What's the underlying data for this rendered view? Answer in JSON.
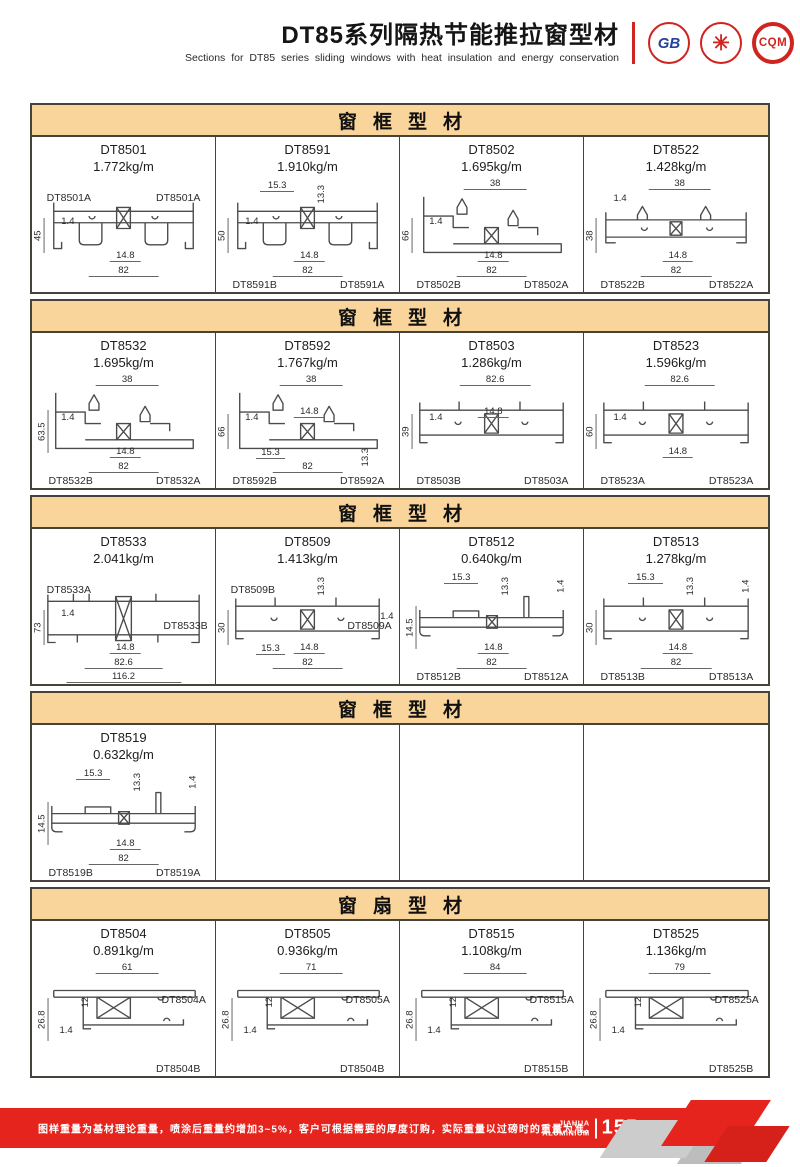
{
  "header": {
    "title": "DT85系列隔热节能推拉窗型材",
    "subtitle": "Sections for DT85 series sliding windows with heat insulation and energy conservation",
    "logos": {
      "gb": "GB",
      "star": "✳",
      "cqm": "CQM"
    }
  },
  "sections": [
    {
      "title": "窗框型材",
      "cells": [
        {
          "model": "DT8501",
          "weight": "1.772kg/m",
          "shape": "double",
          "labels": [
            {
              "v": "DT8501A",
              "role": "lbl-tl"
            },
            {
              "v": "DT8501A",
              "role": "lbl-tr"
            }
          ],
          "dims": [
            {
              "v": "45",
              "role": "h-left"
            },
            {
              "v": "1.4",
              "role": "wall"
            },
            {
              "v": "14.8",
              "role": "gap"
            },
            {
              "v": "82",
              "role": "w-bot"
            }
          ]
        },
        {
          "model": "DT8591",
          "weight": "1.910kg/m",
          "shape": "double",
          "labels": [
            {
              "v": "DT8591B",
              "role": "lbl-bl"
            },
            {
              "v": "DT8591A",
              "role": "lbl-br"
            }
          ],
          "dims": [
            {
              "v": "15.3",
              "role": "notch"
            },
            {
              "v": "13.3",
              "role": "lip"
            },
            {
              "v": "50",
              "role": "h-left"
            },
            {
              "v": "1.4",
              "role": "wall"
            },
            {
              "v": "14.8",
              "role": "gap"
            },
            {
              "v": "82",
              "role": "w-bot"
            }
          ]
        },
        {
          "model": "DT8502",
          "weight": "1.695kg/m",
          "shape": "tall",
          "labels": [
            {
              "v": "DT8502B",
              "role": "lbl-bl"
            },
            {
              "v": "DT8502A",
              "role": "lbl-br"
            }
          ],
          "dims": [
            {
              "v": "38",
              "role": "w-top"
            },
            {
              "v": "66",
              "role": "h-left"
            },
            {
              "v": "1.4",
              "role": "wall"
            },
            {
              "v": "14.8",
              "role": "gap"
            },
            {
              "v": "82",
              "role": "w-bot"
            }
          ]
        },
        {
          "model": "DT8522",
          "weight": "1.428kg/m",
          "shape": "hooks",
          "labels": [
            {
              "v": "DT8522B",
              "role": "lbl-bl"
            },
            {
              "v": "DT8522A",
              "role": "lbl-br"
            }
          ],
          "dims": [
            {
              "v": "38",
              "role": "w-top"
            },
            {
              "v": "1.4",
              "role": "wall-hi"
            },
            {
              "v": "38",
              "role": "h-left"
            },
            {
              "v": "14.8",
              "role": "gap"
            },
            {
              "v": "82",
              "role": "w-bot"
            }
          ]
        }
      ]
    },
    {
      "title": "窗框型材",
      "cells": [
        {
          "model": "DT8532",
          "weight": "1.695kg/m",
          "shape": "tall",
          "labels": [
            {
              "v": "DT8532B",
              "role": "lbl-bl"
            },
            {
              "v": "DT8532A",
              "role": "lbl-br"
            }
          ],
          "dims": [
            {
              "v": "38",
              "role": "w-top"
            },
            {
              "v": "63.5",
              "role": "h-left"
            },
            {
              "v": "1.4",
              "role": "wall"
            },
            {
              "v": "14.8",
              "role": "gap"
            },
            {
              "v": "82",
              "role": "w-bot"
            }
          ]
        },
        {
          "model": "DT8592",
          "weight": "1.767kg/m",
          "shape": "tall",
          "labels": [
            {
              "v": "DT8592B",
              "role": "lbl-bl"
            },
            {
              "v": "DT8592A",
              "role": "lbl-br"
            }
          ],
          "dims": [
            {
              "v": "38",
              "role": "w-top"
            },
            {
              "v": "66",
              "role": "h-left"
            },
            {
              "v": "1.4",
              "role": "wall"
            },
            {
              "v": "14.8",
              "role": "gap-up"
            },
            {
              "v": "15.3",
              "role": "notch-b"
            },
            {
              "v": "82",
              "role": "w-bot"
            },
            {
              "v": "13.3",
              "role": "lip-b"
            }
          ]
        },
        {
          "model": "DT8503",
          "weight": "1.286kg/m",
          "shape": "flat",
          "labels": [
            {
              "v": "DT8503B",
              "role": "lbl-bl"
            },
            {
              "v": "DT8503A",
              "role": "lbl-br"
            }
          ],
          "dims": [
            {
              "v": "82.6",
              "role": "w-top"
            },
            {
              "v": "1.4",
              "role": "wall"
            },
            {
              "v": "14.8",
              "role": "gap-up"
            },
            {
              "v": "39",
              "role": "h-left"
            }
          ]
        },
        {
          "model": "DT8523",
          "weight": "1.596kg/m",
          "shape": "flat",
          "labels": [
            {
              "v": "DT8523A",
              "role": "lbl-bl"
            },
            {
              "v": "DT8523A",
              "role": "lbl-br"
            }
          ],
          "dims": [
            {
              "v": "82.6",
              "role": "w-top"
            },
            {
              "v": "60",
              "role": "h-left"
            },
            {
              "v": "1.4",
              "role": "wall"
            },
            {
              "v": "14.8",
              "role": "gap"
            }
          ]
        }
      ]
    },
    {
      "title": "窗框型材",
      "cells": [
        {
          "model": "DT8533",
          "weight": "2.041kg/m",
          "shape": "wide",
          "labels": [
            {
              "v": "DT8533A",
              "role": "lbl-tl"
            },
            {
              "v": "DT8533B",
              "role": "lbl-r"
            }
          ],
          "dims": [
            {
              "v": "73",
              "role": "h-left"
            },
            {
              "v": "1.4",
              "role": "wall"
            },
            {
              "v": "14.8",
              "role": "gap"
            },
            {
              "v": "82.6",
              "role": "w-bot"
            },
            {
              "v": "116.2",
              "role": "w-bot2"
            }
          ]
        },
        {
          "model": "DT8509",
          "weight": "1.413kg/m",
          "shape": "flat",
          "labels": [
            {
              "v": "DT8509B",
              "role": "lbl-tl"
            },
            {
              "v": "DT8509A",
              "role": "lbl-r"
            }
          ],
          "dims": [
            {
              "v": "13.3",
              "role": "lip"
            },
            {
              "v": "30",
              "role": "h-left"
            },
            {
              "v": "1.4",
              "role": "wall-r"
            },
            {
              "v": "15.3",
              "role": "notch-b"
            },
            {
              "v": "14.8",
              "role": "gap"
            },
            {
              "v": "82",
              "role": "w-bot"
            }
          ]
        },
        {
          "model": "DT8512",
          "weight": "0.640kg/m",
          "shape": "thin",
          "labels": [
            {
              "v": "DT8512B",
              "role": "lbl-bl"
            },
            {
              "v": "DT8512A",
              "role": "lbl-br"
            }
          ],
          "dims": [
            {
              "v": "15.3",
              "role": "notch"
            },
            {
              "v": "13.3",
              "role": "lip"
            },
            {
              "v": "1.4",
              "role": "wall-tr"
            },
            {
              "v": "14.5",
              "role": "h-left"
            },
            {
              "v": "14.8",
              "role": "gap"
            },
            {
              "v": "82",
              "role": "w-bot"
            }
          ]
        },
        {
          "model": "DT8513",
          "weight": "1.278kg/m",
          "shape": "flat",
          "labels": [
            {
              "v": "DT8513B",
              "role": "lbl-bl"
            },
            {
              "v": "DT8513A",
              "role": "lbl-br"
            }
          ],
          "dims": [
            {
              "v": "15.3",
              "role": "notch"
            },
            {
              "v": "13.3",
              "role": "lip"
            },
            {
              "v": "1.4",
              "role": "wall-tr"
            },
            {
              "v": "30",
              "role": "h-left"
            },
            {
              "v": "14.8",
              "role": "gap"
            },
            {
              "v": "82",
              "role": "w-bot"
            }
          ]
        }
      ]
    },
    {
      "title": "窗框型材",
      "cells": [
        {
          "model": "DT8519",
          "weight": "0.632kg/m",
          "shape": "thin",
          "labels": [
            {
              "v": "DT8519B",
              "role": "lbl-bl"
            },
            {
              "v": "DT8519A",
              "role": "lbl-br"
            }
          ],
          "dims": [
            {
              "v": "15.3",
              "role": "notch"
            },
            {
              "v": "13.3",
              "role": "lip"
            },
            {
              "v": "1.4",
              "role": "wall-tr"
            },
            {
              "v": "14.5",
              "role": "h-left"
            },
            {
              "v": "14.8",
              "role": "gap"
            },
            {
              "v": "82",
              "role": "w-bot"
            }
          ]
        },
        {},
        {},
        {}
      ]
    },
    {
      "title": "窗扇型材",
      "cells": [
        {
          "model": "DT8504",
          "weight": "0.891kg/m",
          "shape": "sash",
          "labels": [
            {
              "v": "DT8504A",
              "role": "lbl-r-hi"
            },
            {
              "v": "DT8504B",
              "role": "lbl-br"
            }
          ],
          "dims": [
            {
              "v": "61",
              "role": "w-top"
            },
            {
              "v": "26.8",
              "role": "h-left"
            },
            {
              "v": "12",
              "role": "inner"
            },
            {
              "v": "1.4",
              "role": "wall-lo"
            }
          ]
        },
        {
          "model": "DT8505",
          "weight": "0.936kg/m",
          "shape": "sash",
          "labels": [
            {
              "v": "DT8505A",
              "role": "lbl-r-hi"
            },
            {
              "v": "DT8504B",
              "role": "lbl-br"
            }
          ],
          "dims": [
            {
              "v": "71",
              "role": "w-top"
            },
            {
              "v": "26.8",
              "role": "h-left"
            },
            {
              "v": "12",
              "role": "inner"
            },
            {
              "v": "1.4",
              "role": "wall-lo"
            }
          ]
        },
        {
          "model": "DT8515",
          "weight": "1.108kg/m",
          "shape": "sash",
          "labels": [
            {
              "v": "DT8515A",
              "role": "lbl-r-hi"
            },
            {
              "v": "DT8515B",
              "role": "lbl-br"
            }
          ],
          "dims": [
            {
              "v": "84",
              "role": "w-top"
            },
            {
              "v": "26.8",
              "role": "h-left"
            },
            {
              "v": "12",
              "role": "inner"
            },
            {
              "v": "1.4",
              "role": "wall-lo"
            }
          ]
        },
        {
          "model": "DT8525",
          "weight": "1.136kg/m",
          "shape": "sash",
          "labels": [
            {
              "v": "DT8525A",
              "role": "lbl-r-hi"
            },
            {
              "v": "DT8525B",
              "role": "lbl-br"
            }
          ],
          "dims": [
            {
              "v": "79",
              "role": "w-top"
            },
            {
              "v": "26.8",
              "role": "h-left"
            },
            {
              "v": "12",
              "role": "inner"
            },
            {
              "v": "1.4",
              "role": "wall-lo"
            }
          ]
        }
      ]
    }
  ],
  "footer": {
    "note": "图样重量为基材理论重量，喷涂后重量约增加3~5%，客户可根据需要的厚度订购，实际重量以过磅时的重量为准。",
    "brand_top": "JIAHUA",
    "brand_bottom": "ALUMINIUM",
    "page_number": "155"
  }
}
